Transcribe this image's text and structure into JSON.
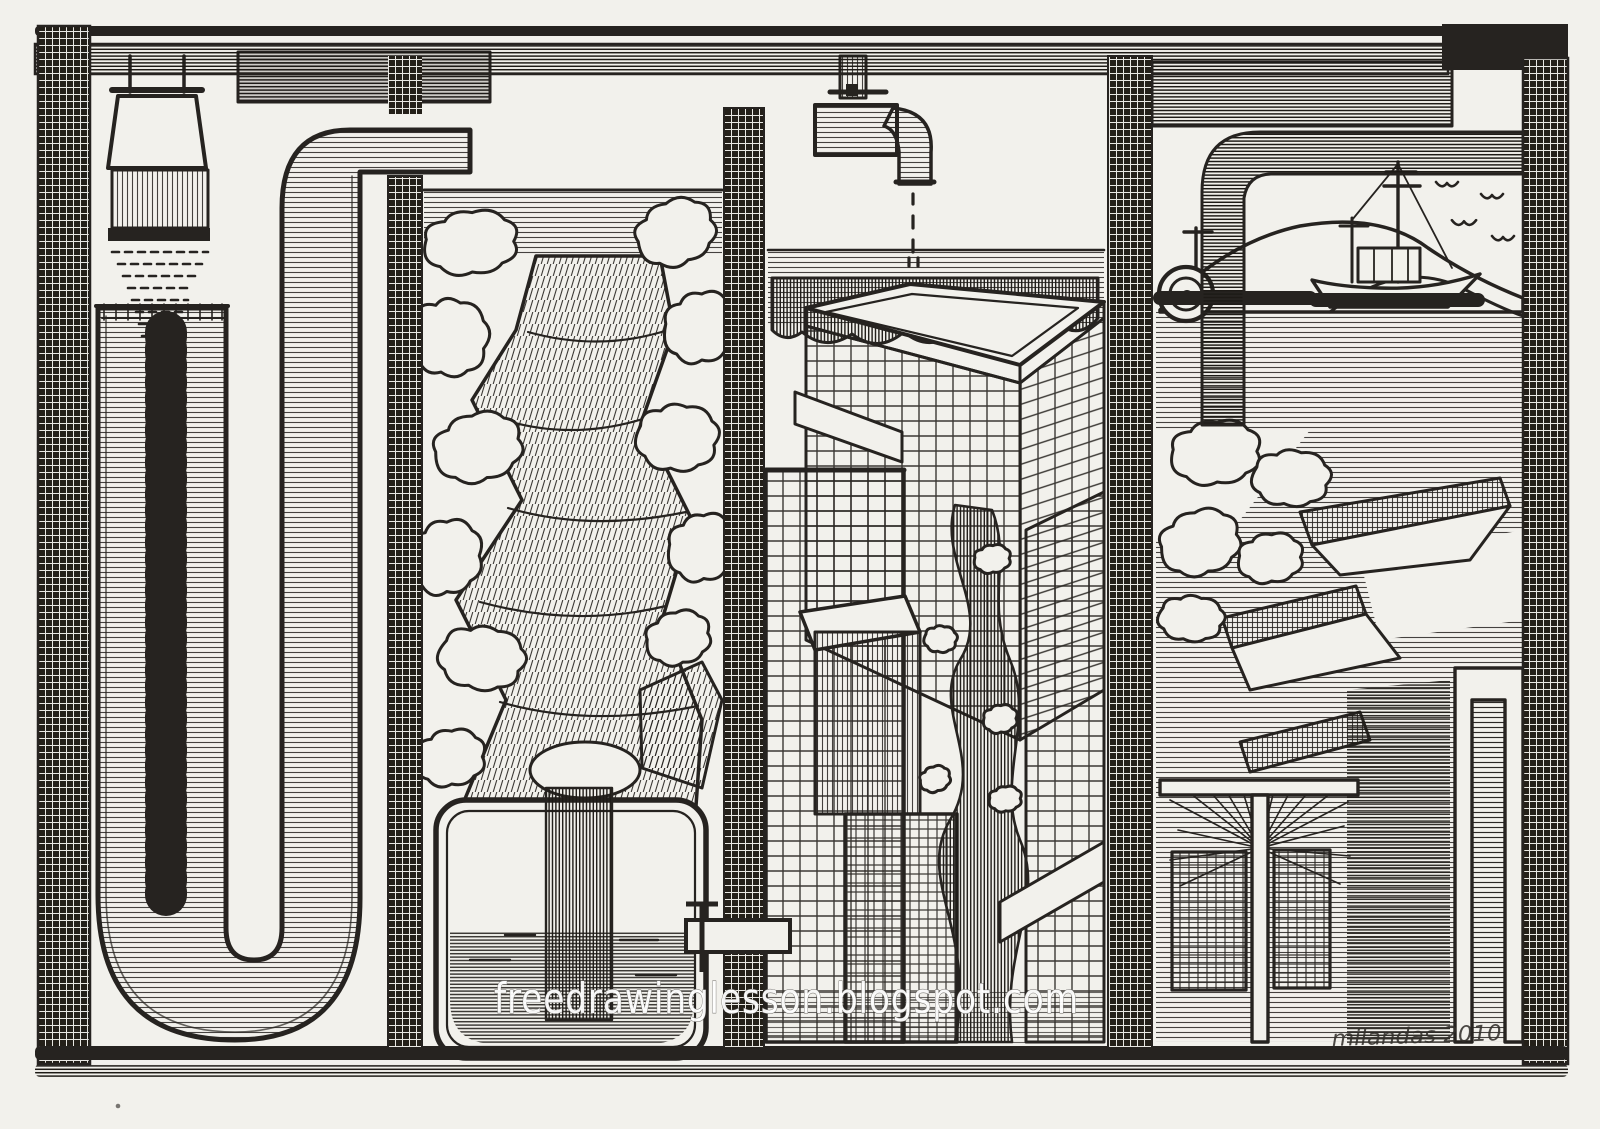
{
  "watermark": {
    "text": "freedrawinglesson.blogspot.com"
  },
  "signature": {
    "text": "milandas 2010"
  },
  "palette": {
    "ink": "#262320",
    "paper": "#f2f1ec",
    "watermark": "#ffffff"
  },
  "scenes": [
    {
      "id": "lamp-u-tube",
      "label": "Hanging lamp shining into a large U-shaped tube filled with water"
    },
    {
      "id": "forest-waterfall",
      "label": "Waterfall cascading through forest foliage into a rounded tank with a valve"
    },
    {
      "id": "faucet-city",
      "label": "Dripping faucet above modern gridded buildings with a stream winding between them"
    },
    {
      "id": "harbor",
      "label": "Harbor scene with fishing boat, mountains, gulls, life buoy, terraced piers and a thatched pavilion"
    }
  ],
  "frame": {
    "label": "crosshatched ink border frame with panel dividers"
  }
}
